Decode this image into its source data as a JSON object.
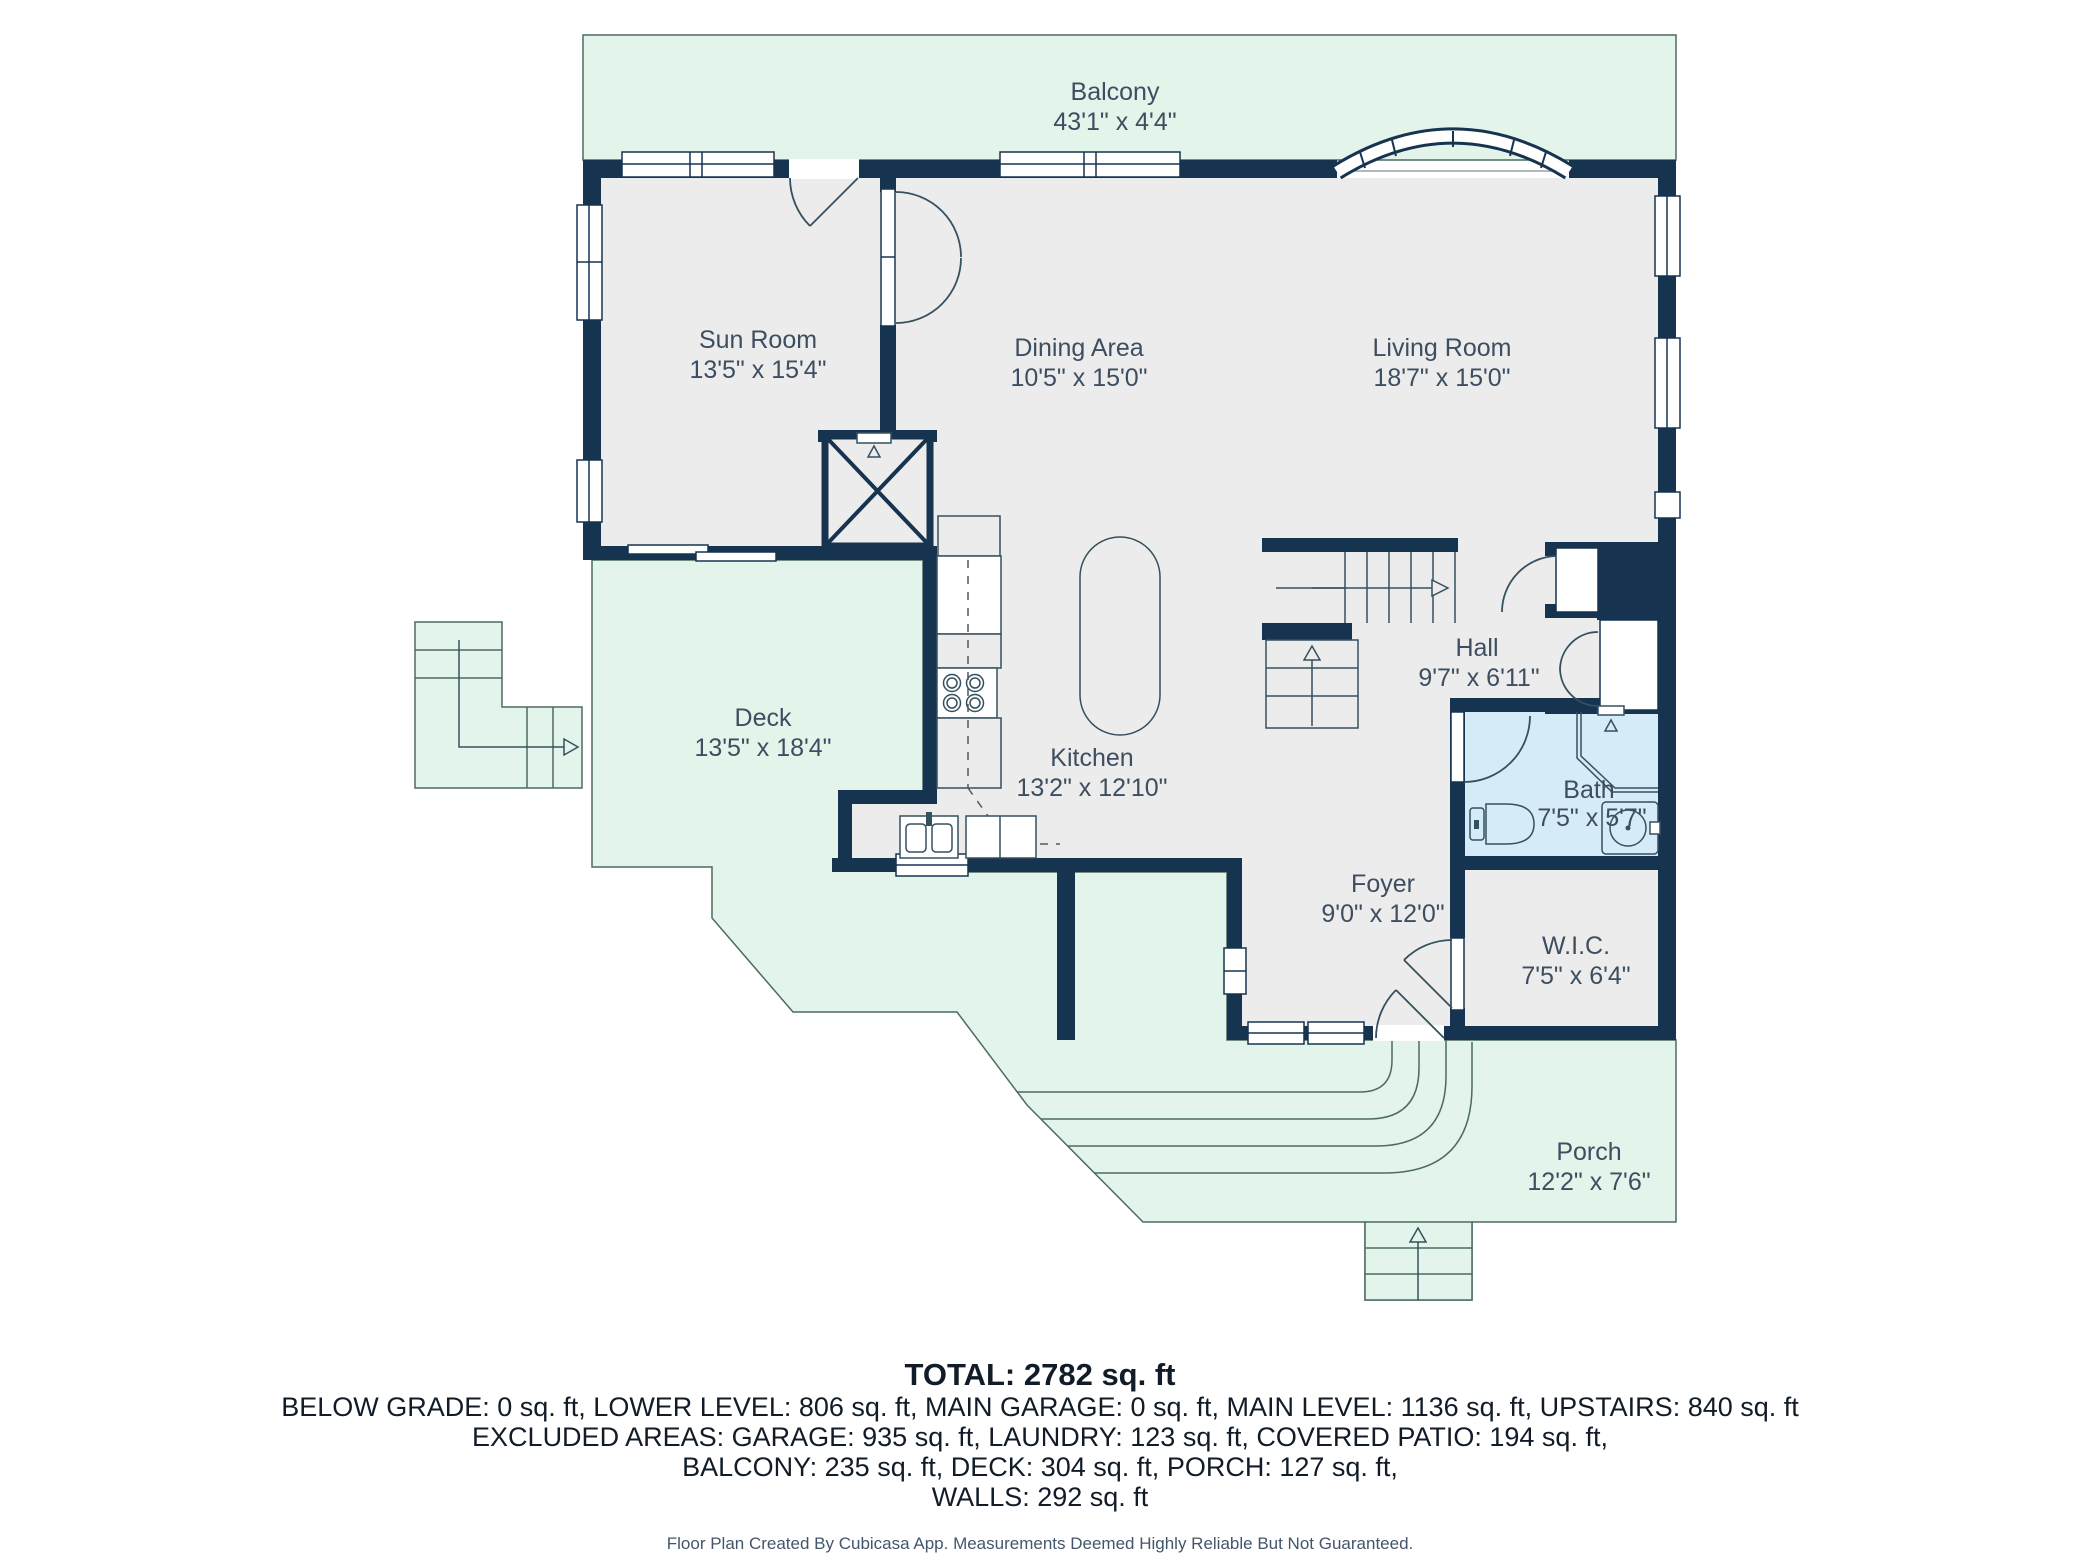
{
  "title": "Main level floor plan",
  "colors": {
    "wall": "#163450",
    "floor": "#ececec",
    "outdoor_fill": "#e3f4ea",
    "outdoor_stroke": "#4c6b63",
    "bath_floor": "#d6ebf8",
    "fixture_stroke": "#35505f",
    "label_text": "#3d4e60",
    "summary_text": "#111c28",
    "footer_text": "#44566b"
  },
  "rooms": [
    {
      "name": "Balcony",
      "dims": "43'1\" x 4'4\""
    },
    {
      "name": "Sun Room",
      "dims": "13'5\" x 15'4\""
    },
    {
      "name": "Dining Area",
      "dims": "10'5\" x 15'0\""
    },
    {
      "name": "Living Room",
      "dims": "18'7\" x 15'0\""
    },
    {
      "name": "Deck",
      "dims": "13'5\" x 18'4\""
    },
    {
      "name": "Kitchen",
      "dims": "13'2\" x 12'10\""
    },
    {
      "name": "Hall",
      "dims": "9'7\" x 6'11\""
    },
    {
      "name": "Bath",
      "dims": "7'5\" x 5'7\""
    },
    {
      "name": "Foyer",
      "dims": "9'0\" x 12'0\""
    },
    {
      "name": "W.I.C.",
      "dims": "7'5\" x 6'4\""
    },
    {
      "name": "Porch",
      "dims": "12'2\" x 7'6\""
    }
  ],
  "summary": {
    "total": "TOTAL: 2782 sq. ft",
    "lines": [
      "BELOW GRADE: 0 sq. ft, LOWER LEVEL: 806 sq. ft, MAIN GARAGE: 0 sq. ft, MAIN LEVEL: 1136 sq. ft, UPSTAIRS: 840 sq. ft",
      "EXCLUDED AREAS: GARAGE: 935 sq. ft, LAUNDRY: 123 sq. ft, COVERED PATIO: 194 sq. ft,",
      "BALCONY: 235 sq. ft, DECK: 304 sq. ft, PORCH: 127 sq. ft,",
      "WALLS: 292 sq. ft"
    ]
  },
  "footer": {
    "text": "Floor Plan Created By Cubicasa App. Measurements Deemed Highly Reliable But Not Guaranteed."
  }
}
